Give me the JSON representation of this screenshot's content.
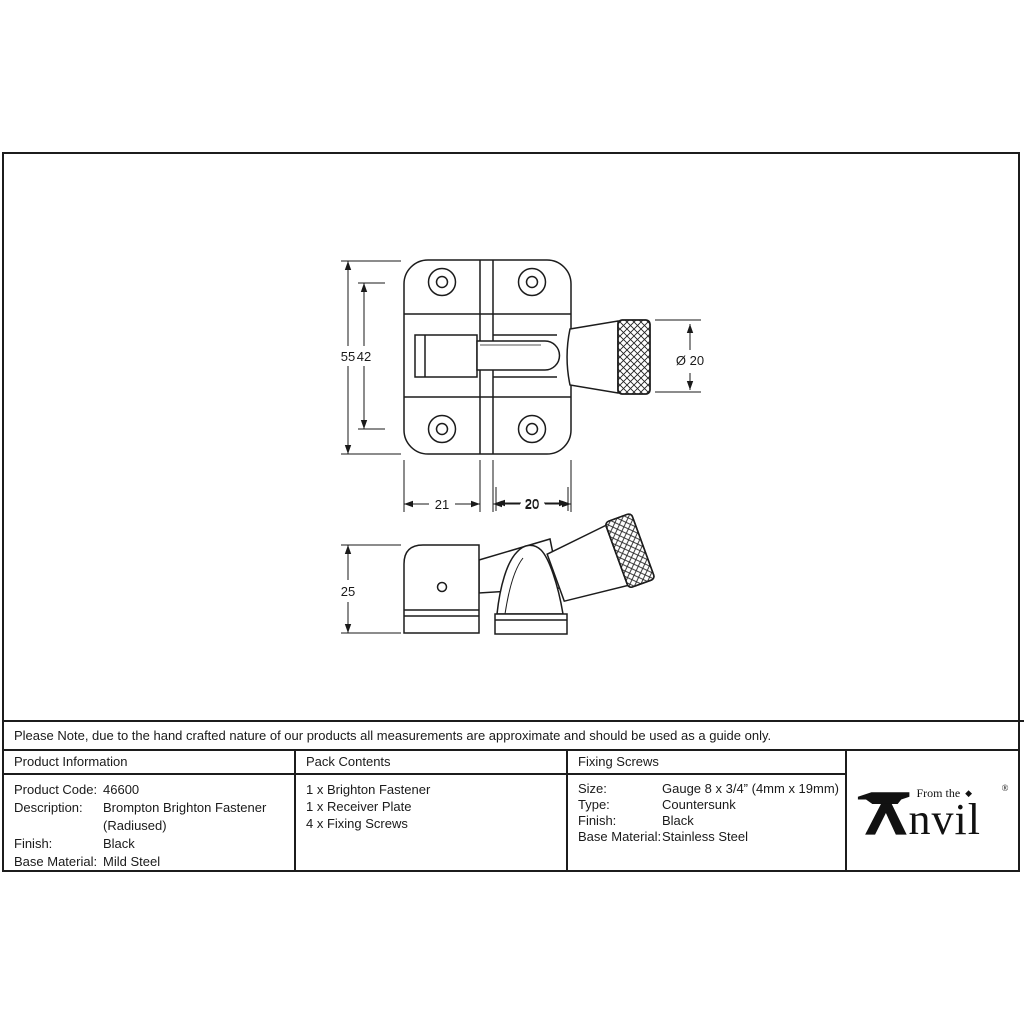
{
  "page": {
    "note": "Please Note, due to the hand crafted nature of our products all measurements are approximate and should be used as a guide only."
  },
  "drawing": {
    "dims": {
      "overall_height": "55",
      "hole_spacing": "42",
      "knob_diameter": "Ø 20",
      "plate_left_width": "21",
      "plate_right_width": "20",
      "side_height": "25",
      "side_width": "20"
    }
  },
  "table": {
    "product_information": {
      "title": "Product Information",
      "rows": [
        {
          "label": "Product Code:",
          "value": "46600"
        },
        {
          "label": "Description:",
          "value": "Brompton Brighton Fastener (Radiused)"
        },
        {
          "label": "Finish:",
          "value": "Black"
        },
        {
          "label": "Base Material:",
          "value": "Mild Steel"
        }
      ]
    },
    "pack_contents": {
      "title": "Pack Contents",
      "items": [
        "1 x Brighton Fastener",
        "1 x Receiver Plate",
        "4 x Fixing Screws"
      ]
    },
    "fixing_screws": {
      "title": "Fixing Screws",
      "rows": [
        {
          "label": "Size:",
          "value": "Gauge 8 x 3/4” (4mm x 19mm)"
        },
        {
          "label": "Type:",
          "value": "Countersunk"
        },
        {
          "label": "Finish:",
          "value": "Black"
        },
        {
          "label": "Base Material:",
          "value": "Stainless Steel"
        }
      ]
    },
    "logo": {
      "tagline": "From the",
      "wordmark_rest": "nvil",
      "registered": "®"
    }
  }
}
